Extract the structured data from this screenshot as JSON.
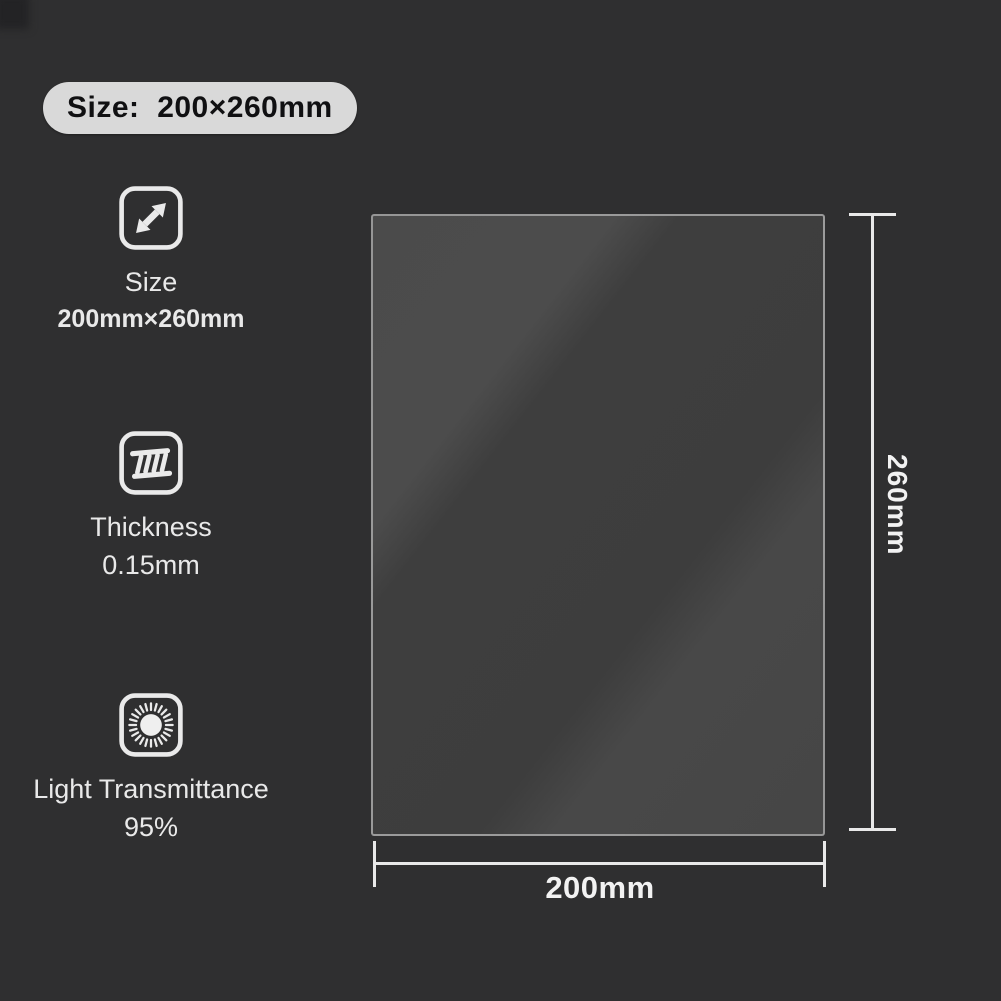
{
  "badge": {
    "label": "Size:  200×260mm"
  },
  "features": [
    {
      "icon": "resize-arrows-icon",
      "label": "Size",
      "value": "200mm×260mm"
    },
    {
      "icon": "thickness-icon",
      "label": "Thickness",
      "value": "0.15mm"
    },
    {
      "icon": "sun-icon",
      "label": "Light Transmittance",
      "value": "95%"
    }
  ],
  "diagram": {
    "height_label": "260mm",
    "width_label": "200mm"
  },
  "colors": {
    "background": "#2f2f30",
    "badge_background": "#d9d9d9",
    "badge_text": "#101012",
    "label_text": "#e9e9e9",
    "dimension_line": "#e9e9e9",
    "sheet_fill_light": "#4b4b4b",
    "sheet_fill_dark": "#3d3d3d",
    "sheet_border": "#c6c6c6"
  }
}
